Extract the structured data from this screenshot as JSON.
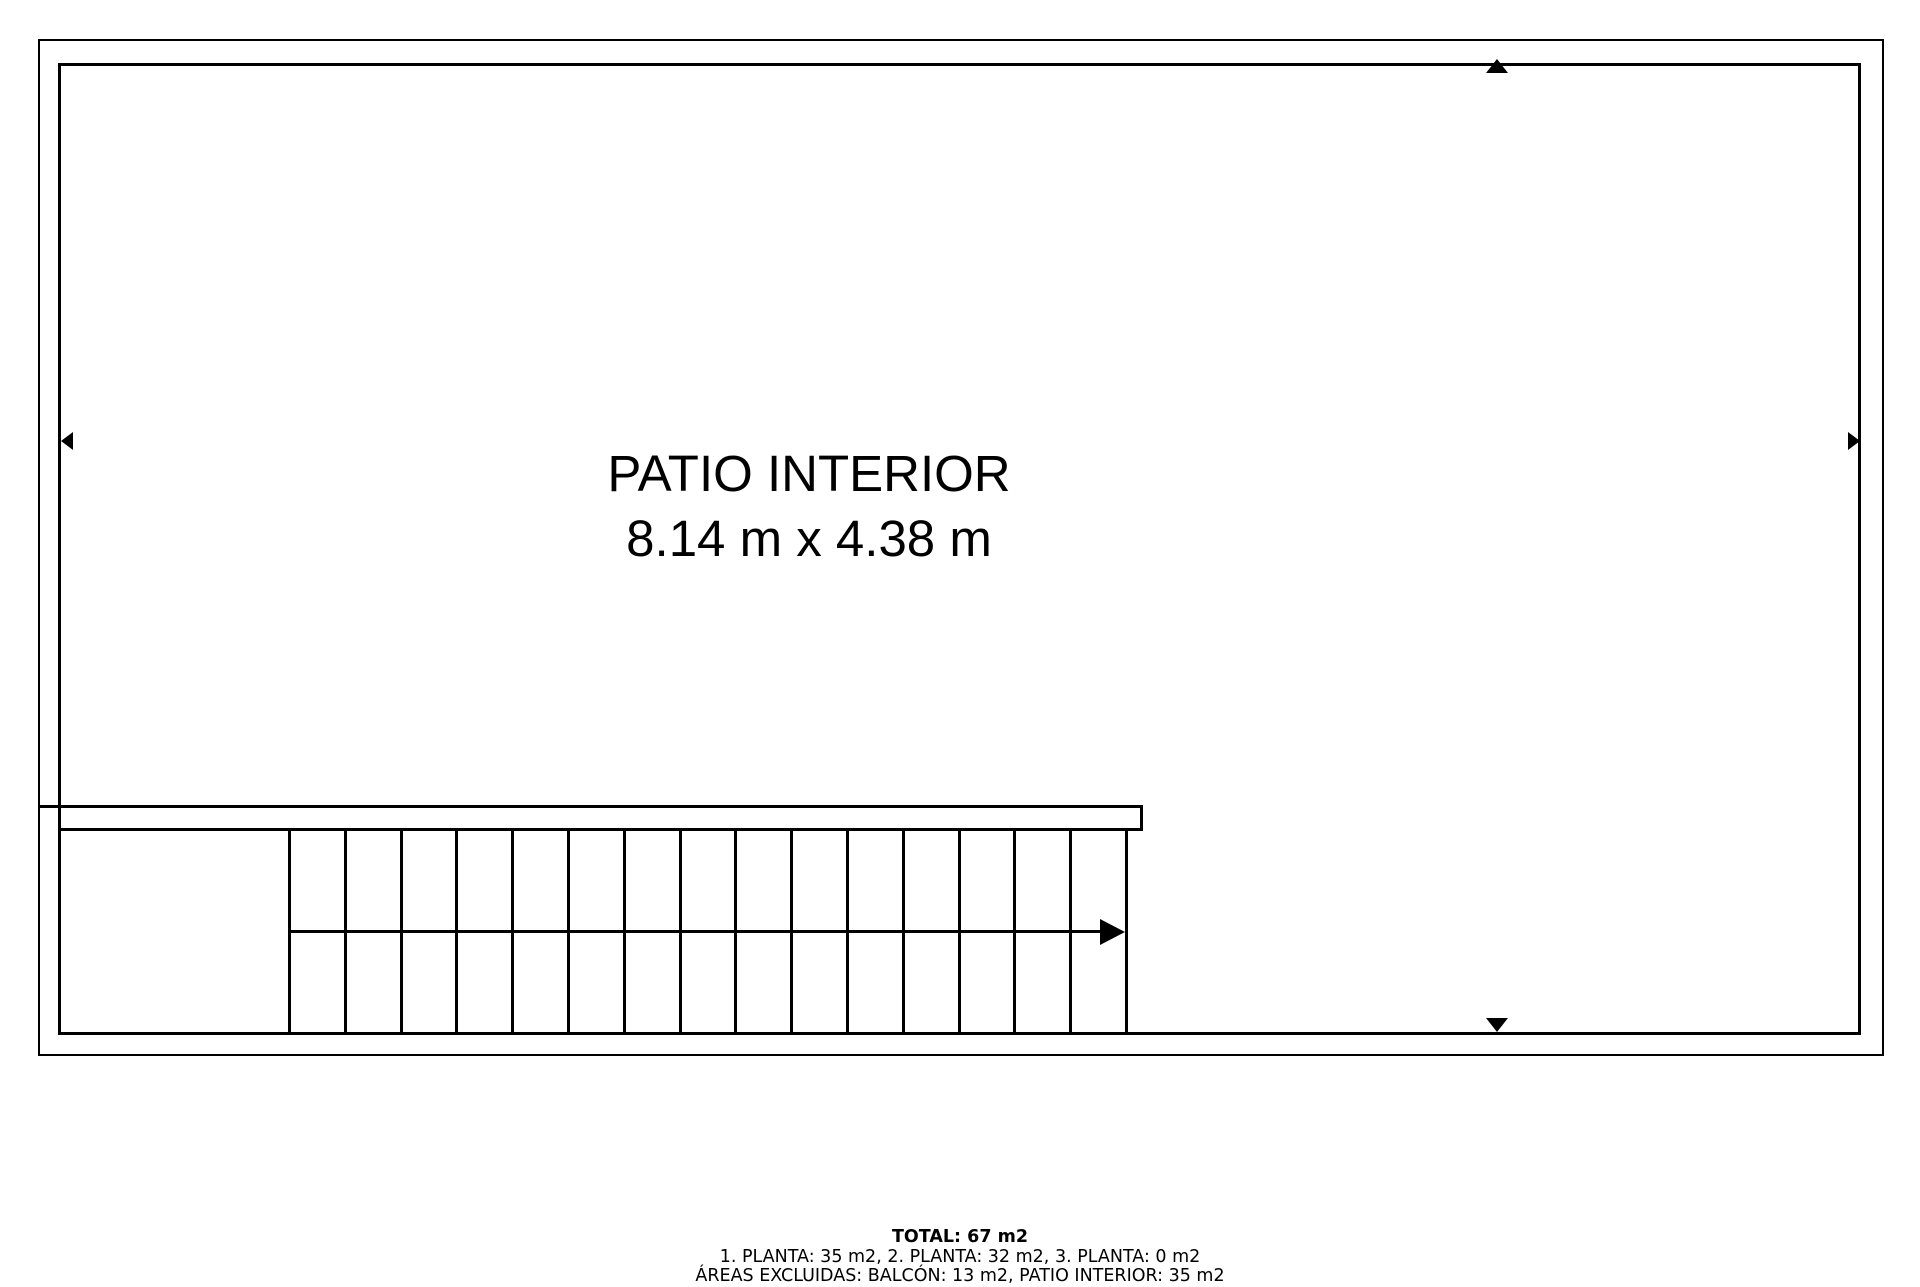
{
  "floorplan": {
    "room": {
      "label": "PATIO INTERIOR",
      "dimensions": "8.14 m x 4.38 m"
    },
    "stairs": {
      "steps": 15,
      "start_x": 288,
      "step_width": 55.8,
      "direction": "right"
    },
    "colors": {
      "line": "#000000",
      "background": "#ffffff"
    }
  },
  "footer": {
    "total": "TOTAL: 67 m2",
    "floors": "1. PLANTA: 35 m2, 2. PLANTA: 32 m2, 3. PLANTA: 0 m2",
    "excluded": "ÁREAS EXCLUIDAS: BALCÓN: 13 m2, PATIO INTERIOR: 35 m2"
  }
}
